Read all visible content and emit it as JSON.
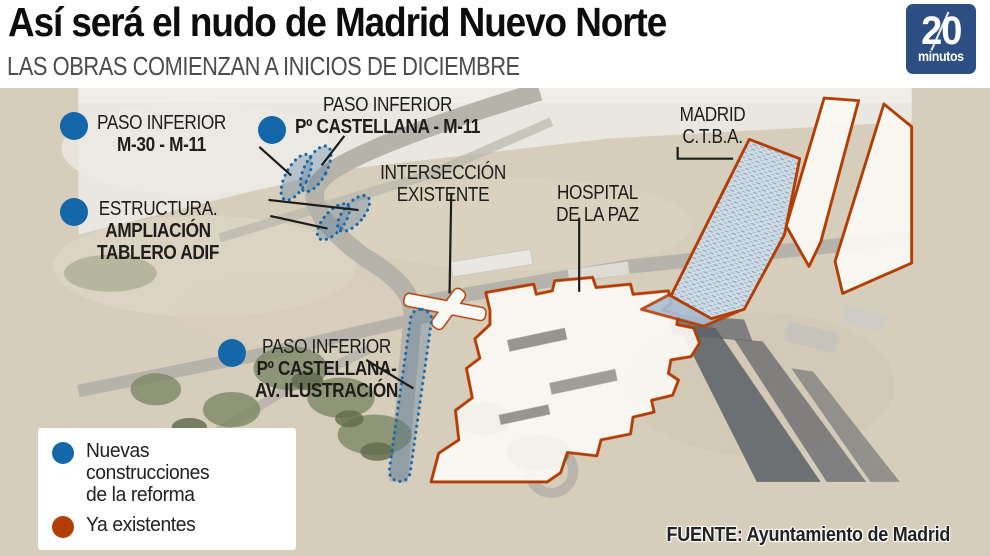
{
  "header": {
    "title": "Así será el nudo de Madrid Nuevo Norte",
    "subtitle": "LAS OBRAS COMIENZAN A INICIOS DE DICIEMBRE",
    "logo": {
      "number": "20",
      "word": "minutos"
    }
  },
  "colors": {
    "new_blue": "#1467a8",
    "existing_orange": "#b23e06",
    "logo_blue": "#2d4e82"
  },
  "map": {
    "labels": {
      "paso_m30": {
        "line1": "PASO INFERIOR",
        "line2": "M-30 - M-11"
      },
      "paso_castellana_m11": {
        "line1": "PASO INFERIOR",
        "line2": "Pº CASTELLANA - M-11"
      },
      "estructura": {
        "line1": "ESTRUCTURA.",
        "line2": "AMPLIACIÓN",
        "line3": "TABLERO ADIF"
      },
      "interseccion": {
        "line1": "INTERSECCIÓN",
        "line2": "EXISTENTE"
      },
      "hospital": {
        "line1": "HOSPITAL",
        "line2": "DE LA PAZ"
      },
      "ctba": {
        "line1": "MADRID",
        "line2": "C.T.B.A."
      },
      "paso_castellana_av": {
        "line1": "PASO INFERIOR",
        "line2": "Pº CASTELLANA-",
        "line3": "AV. ILUSTRACIÓN"
      }
    },
    "legend": {
      "new_line1": "Nuevas construcciones",
      "new_line2": "de la reforma",
      "existing": "Ya existentes"
    },
    "source": "FUENTE: Ayuntamiento de Madrid"
  }
}
